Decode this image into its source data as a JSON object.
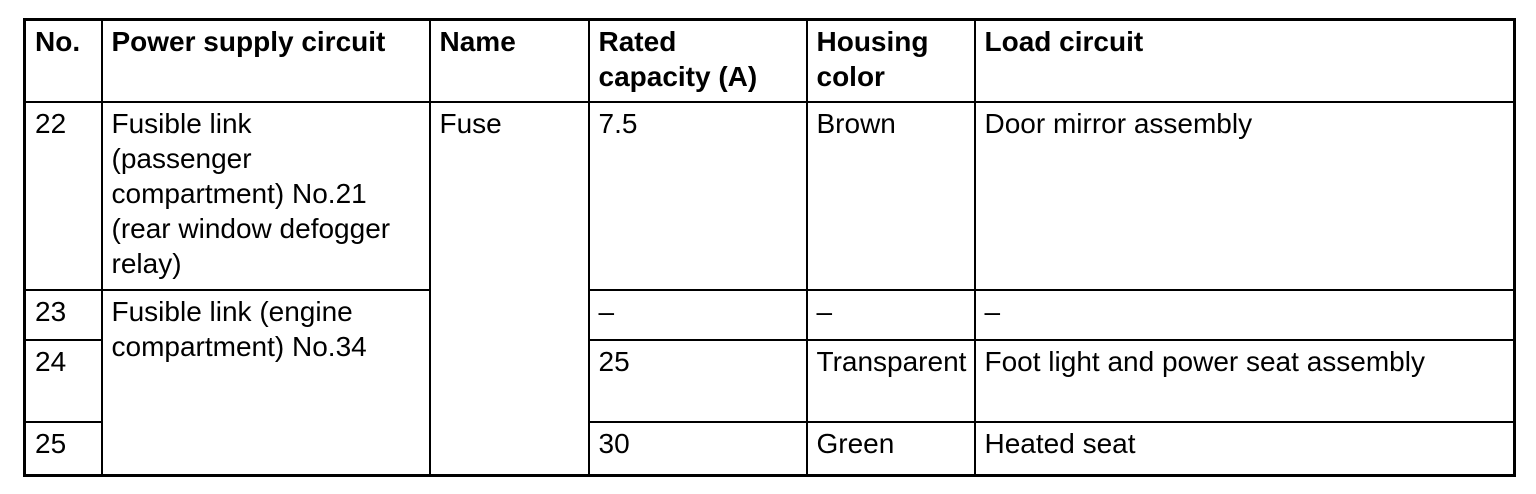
{
  "table": {
    "columns": [
      {
        "label": "No."
      },
      {
        "label": "Power supply circuit"
      },
      {
        "label": "Name"
      },
      {
        "label": "Rated\ncapacity (A)"
      },
      {
        "label": "Housing\ncolor"
      },
      {
        "label": "Load circuit"
      }
    ],
    "rows": [
      {
        "no": "22",
        "power_supply_circuit": "Fusible link\n(passenger\ncompartment) No.21\n(rear window defogger\nrelay)",
        "name": "Fuse",
        "rated_capacity": "7.5",
        "housing_color": "Brown",
        "load_circuit": "Door mirror assembly"
      },
      {
        "no": "23",
        "power_supply_circuit": "Fusible link (engine\ncompartment) No.34",
        "rated_capacity": "–",
        "housing_color": "–",
        "load_circuit": "–"
      },
      {
        "no": "24",
        "rated_capacity": "25",
        "housing_color": "Transparent",
        "load_circuit": "Foot light and power seat assembly"
      },
      {
        "no": "25",
        "rated_capacity": "30",
        "housing_color": "Green",
        "load_circuit": "Heated seat"
      }
    ],
    "colors": {
      "text": "#000000",
      "background": "#ffffff",
      "border": "#000000"
    }
  }
}
